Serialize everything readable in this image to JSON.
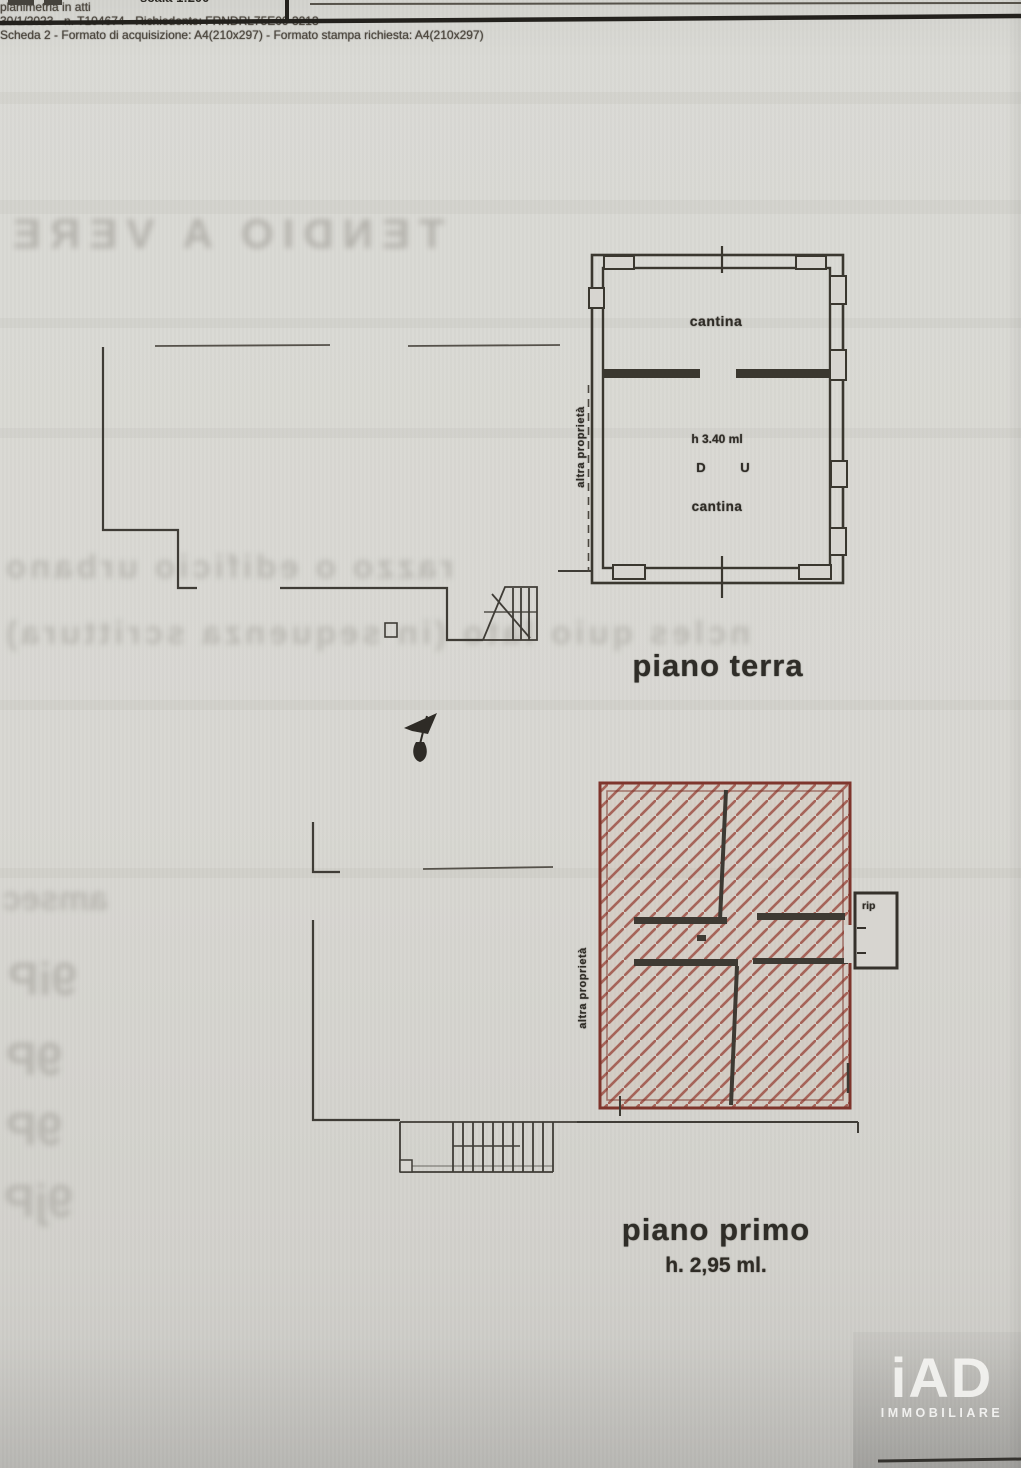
{
  "header": {
    "fragment_scale": "scala 1:200"
  },
  "ground_floor": {
    "caption": "piano terra",
    "room_upper": "cantina",
    "room_lower": "cantina",
    "height_note": "h 3.40 ml",
    "mark_left": "D",
    "mark_right": "U",
    "boundary_label": "altra proprietà"
  },
  "first_floor": {
    "caption": "piano primo",
    "height_note": "h. 2,95 ml.",
    "annex_label": "rip",
    "boundary_label": "altra proprietà"
  },
  "footer": {
    "line1": "planimetria in atti",
    "line2": "30/1/2023 - n. T104674 - Richiedente: FRNDRL75E09 3213",
    "line3": "Scheda 2 - Formato di acquisizione: A4(210x297) - Formato stampa richiesta: A4(210x297)"
  },
  "logo": {
    "brand": "iAD",
    "subtitle": "IMMOBILIARE"
  },
  "ghosts": {
    "g1": "TENDIO A VERE",
    "g2": "razzo o edificio urbano",
    "g3": "ncles quio lato (in sequenza scrittura)",
    "g4a": "amsec",
    "g4b": "9iP",
    "g4c": "9P",
    "g4d": "9P",
    "g4e": "9jP"
  },
  "colors": {
    "paper": "#d7d5d0",
    "ink": "#3a372f",
    "red_border": "#7e352c",
    "red_hatch": "#9a4a3e"
  }
}
